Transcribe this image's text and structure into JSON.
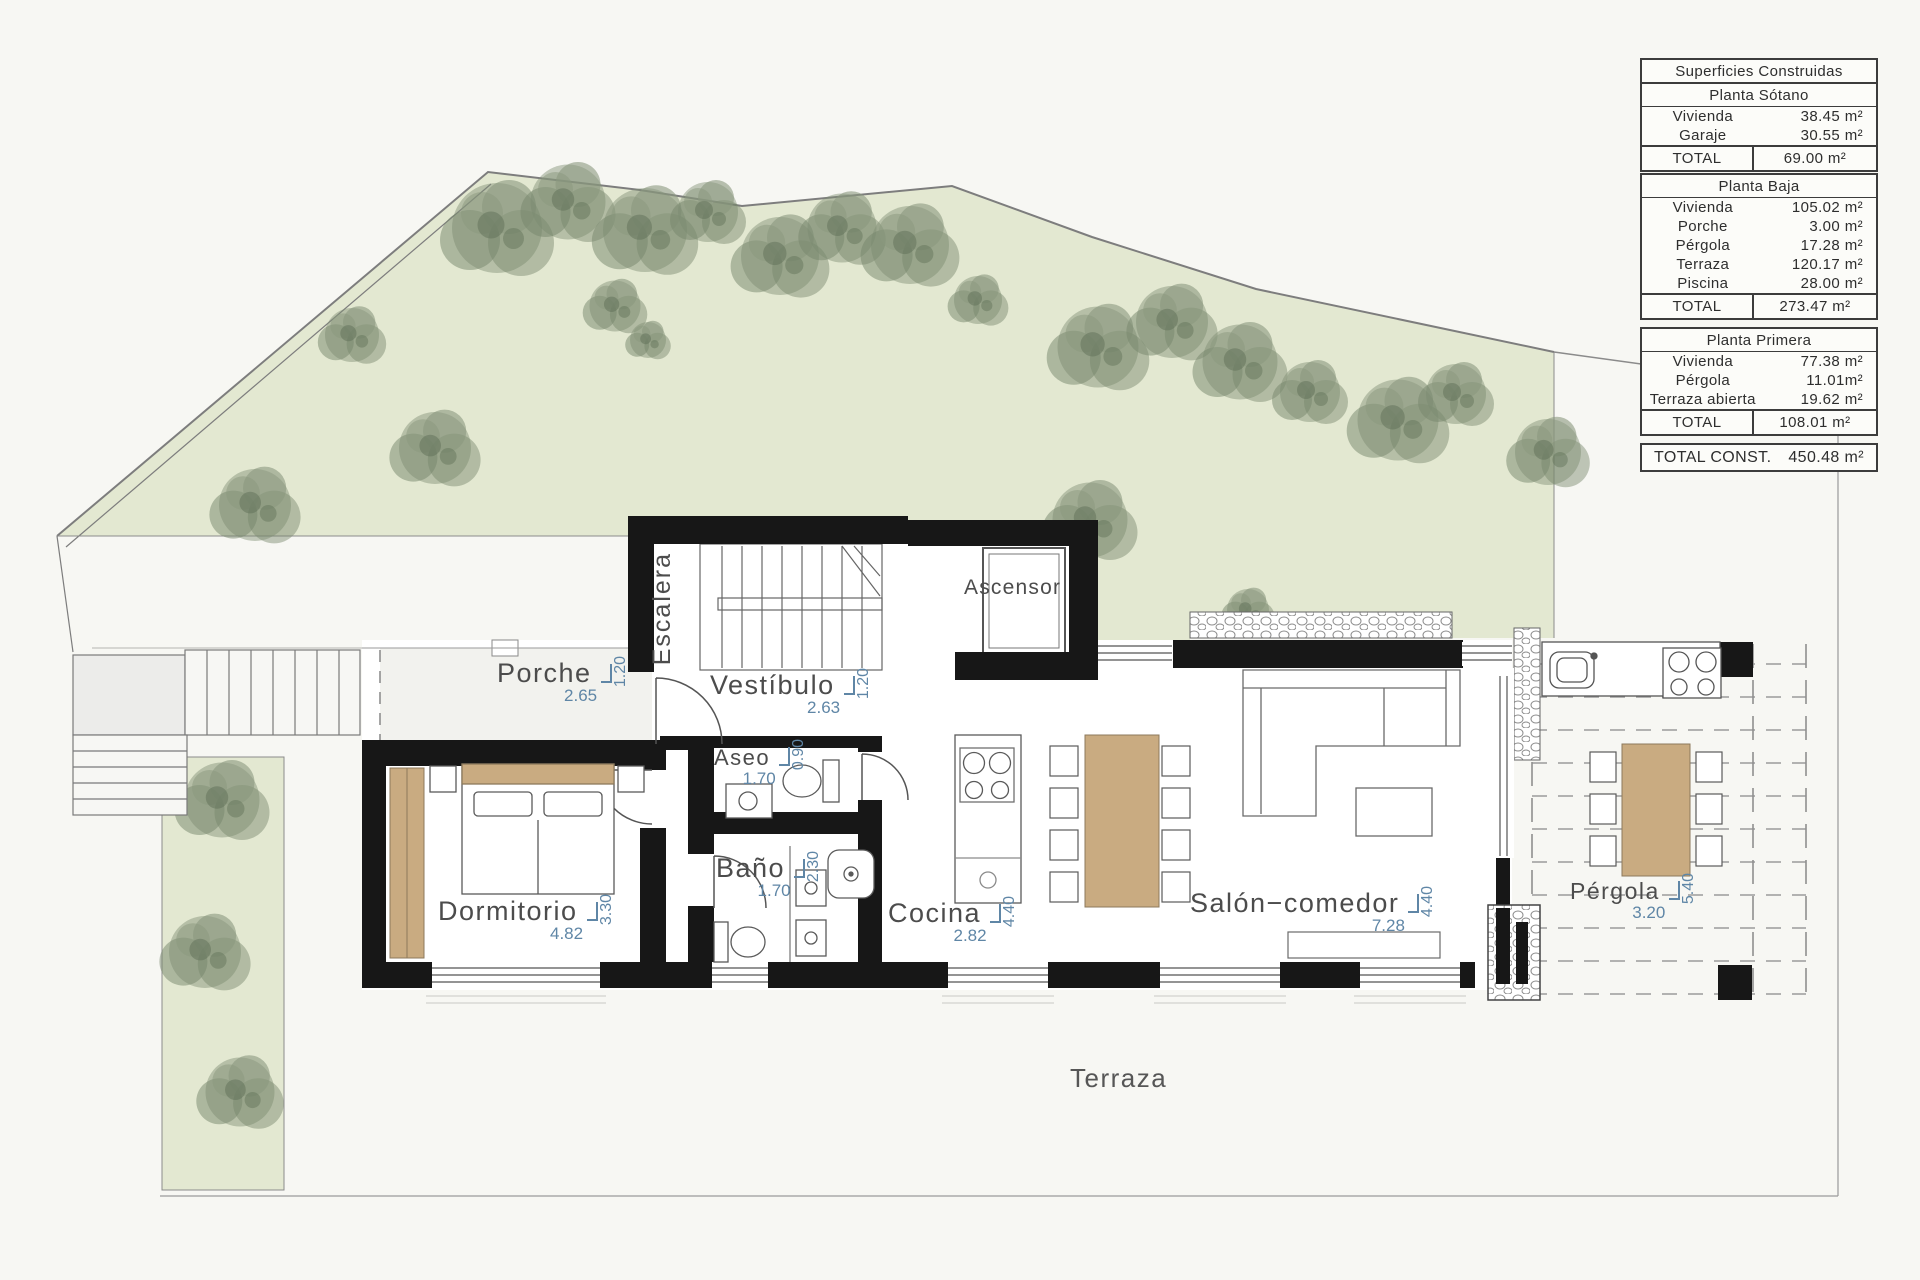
{
  "summary_tables": {
    "construidas": {
      "title": "Superficies Construidas",
      "floor": "Planta Sótano",
      "rows": [
        {
          "label": "Vivienda",
          "value": "38.45 m²"
        },
        {
          "label": "Garaje",
          "value": "30.55 m²"
        }
      ],
      "total_label": "TOTAL",
      "total_value": "69.00 m²"
    },
    "planta_baja": {
      "floor": "Planta Baja",
      "rows": [
        {
          "label": "Vivienda",
          "value": "105.02 m²"
        },
        {
          "label": "Porche",
          "value": "3.00 m²"
        },
        {
          "label": "Pérgola",
          "value": "17.28 m²"
        },
        {
          "label": "Terraza",
          "value": "120.17 m²"
        },
        {
          "label": "Piscina",
          "value": "28.00 m²"
        }
      ],
      "total_label": "TOTAL",
      "total_value": "273.47 m²"
    },
    "planta_primera": {
      "floor": "Planta Primera",
      "rows": [
        {
          "label": "Vivienda",
          "value": "77.38 m²"
        },
        {
          "label": "Pérgola",
          "value": "11.01m²"
        },
        {
          "label": "Terraza abierta",
          "value": "19.62 m²"
        }
      ],
      "total_label": "TOTAL",
      "total_value": "108.01 m²"
    },
    "grand_total": {
      "label": "TOTAL CONST.",
      "value": "450.48 m²"
    }
  },
  "rooms": {
    "porche": {
      "label": "Porche",
      "width": "2.65",
      "depth": "1.20"
    },
    "vestibulo": {
      "label": "Vestíbulo",
      "width": "2.63",
      "depth": "1.20"
    },
    "escalera": {
      "label": "Escalera"
    },
    "ascensor": {
      "label": "Ascensor"
    },
    "aseo": {
      "label": "Aseo",
      "width": "1.70",
      "depth": "0.90"
    },
    "bano": {
      "label": "Baño",
      "width": "1.70",
      "depth": "2.30"
    },
    "dormitorio": {
      "label": "Dormitorio",
      "width": "4.82",
      "depth": "3.30"
    },
    "cocina": {
      "label": "Cocina",
      "width": "2.82",
      "depth": "4.40"
    },
    "salon": {
      "label": "Salón−comedor",
      "width": "7.28",
      "depth": "4.40"
    },
    "pergola": {
      "label": "Pérgola",
      "width": "3.20",
      "depth": "5.40"
    },
    "terraza": {
      "label": "Terraza"
    }
  },
  "colors": {
    "garden": "#e3e8d1",
    "wall": "#171717",
    "wood": "#c9ab81",
    "dimension_text": "#5f86a6",
    "label_text": "#4c4c4c"
  }
}
